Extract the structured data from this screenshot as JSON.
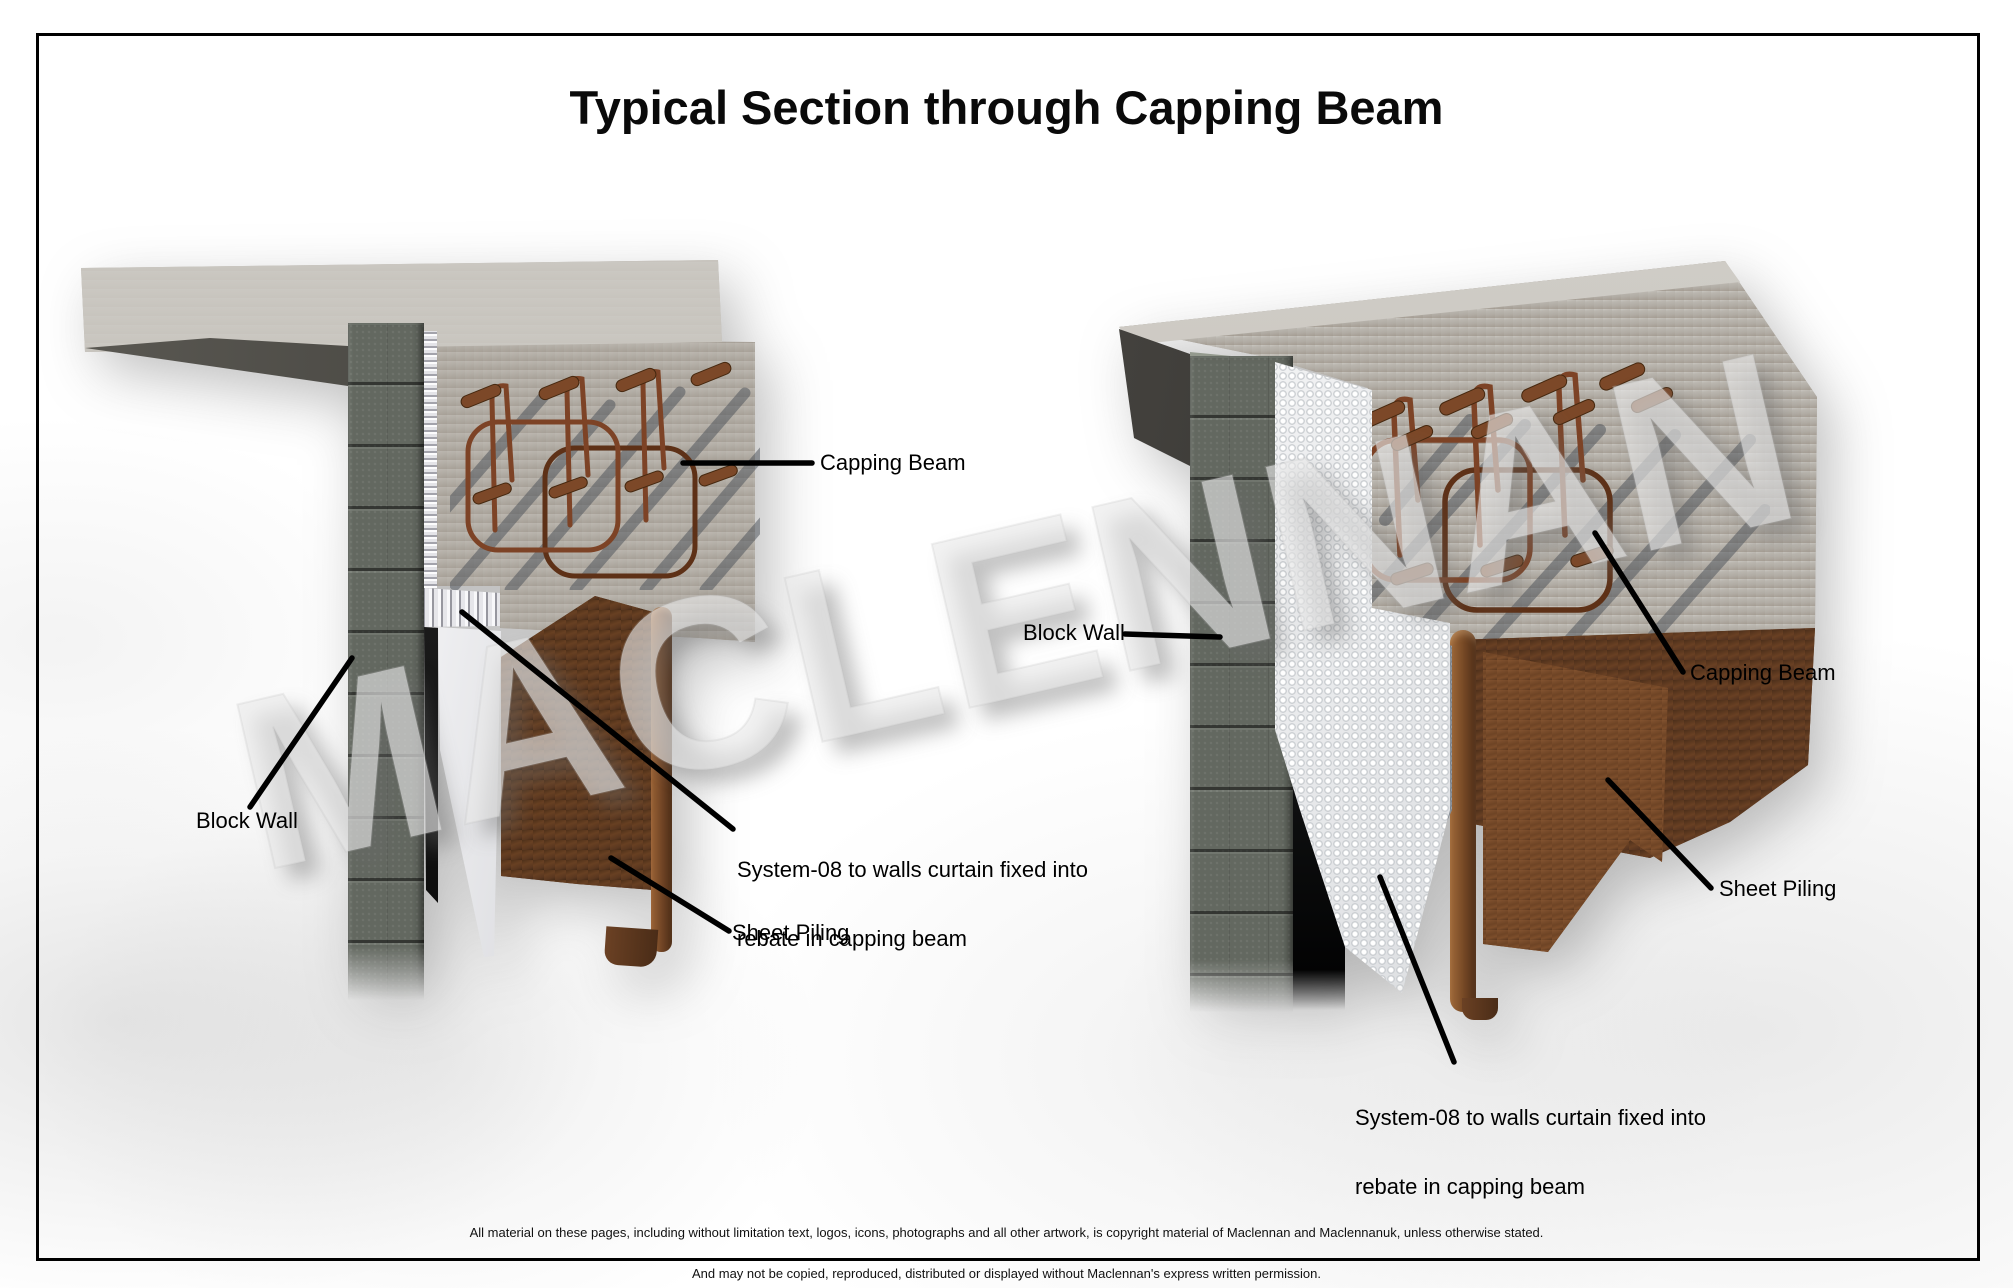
{
  "title": "Typical Section through Capping Beam",
  "watermark": "MACLENNAN",
  "left_diagram": {
    "capping_beam": "Capping Beam",
    "block_wall": "Block Wall",
    "system08_line1": "System-08 to walls curtain fixed into",
    "system08_line2": "rebate in capping beam",
    "sheet_piling": "Sheet Piling"
  },
  "right_diagram": {
    "capping_beam": "Capping Beam",
    "block_wall": "Block Wall",
    "system08_line1": "System-08 to walls curtain fixed into",
    "system08_line2": "rebate in capping beam",
    "sheet_piling": "Sheet Piling"
  },
  "footer": {
    "line1": "All material on these pages, including without limitation text, logos, icons, photographs and all other artwork, is copyright material of Maclennan and Maclennanuk, unless otherwise stated.",
    "line2": "And may not be copied, reproduced, distributed or displayed without Maclennan's express written permission.",
    "line3": "© Copyright 2014, Maclennan.  All rights reserved"
  },
  "colors": {
    "concrete": "#b3aea6",
    "concrete_light": "#c9c6c0",
    "block_wall": "#636860",
    "rust_dark": "#553420",
    "rust_mid": "#6e4426",
    "rust_light": "#8a5733",
    "rebar": "#7d4326",
    "shadow_bar": "#474d55",
    "membrane_white": "#f0f0f2",
    "label_text": "#000000",
    "border": "#000000"
  }
}
